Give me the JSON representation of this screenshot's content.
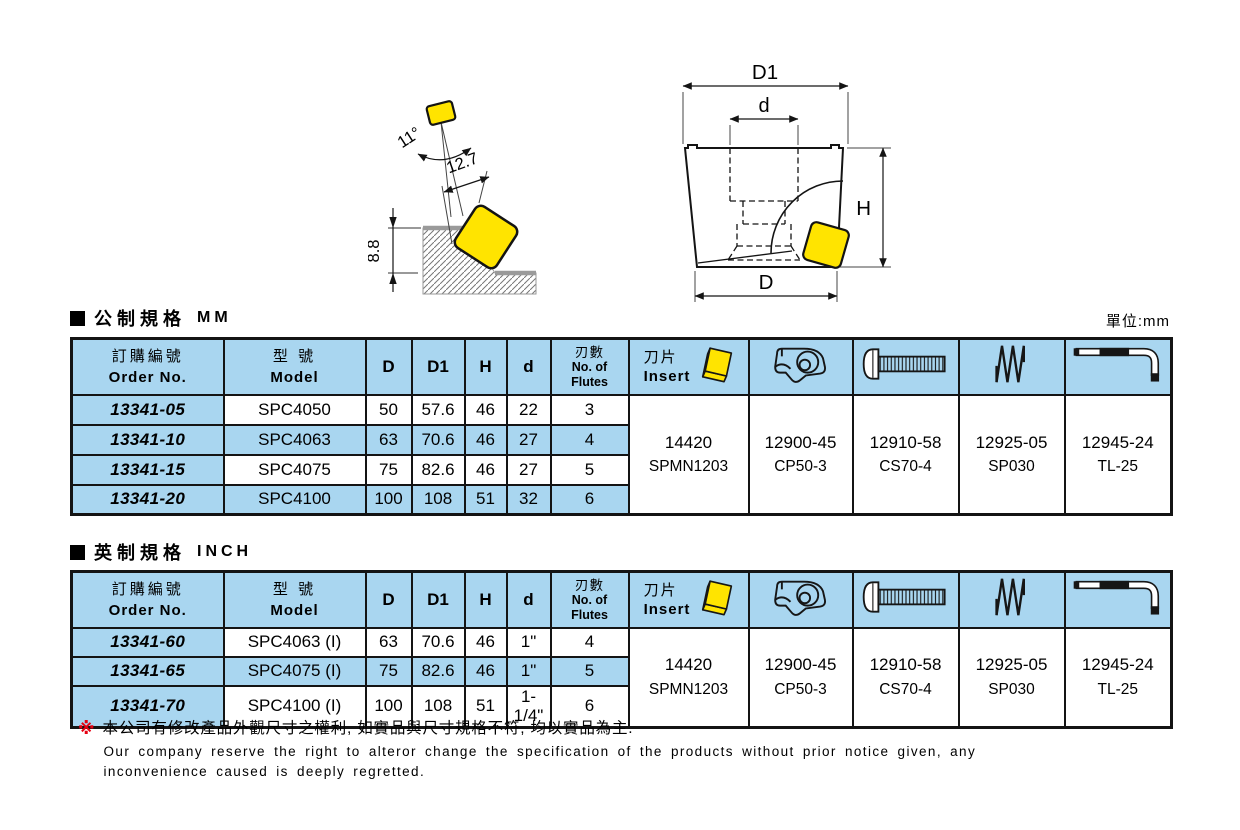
{
  "colors": {
    "header_blue": "#A9D6F0",
    "insert_yellow": "#FFE400",
    "note_red": "#E60012"
  },
  "unit_label": "單位:mm",
  "diagram_left": {
    "angle_label": "11°",
    "width_label": "12.7",
    "depth_label": "8.8"
  },
  "diagram_right": {
    "top_dia_label": "D1",
    "bore_label": "d",
    "height_label": "H",
    "bottom_dia_label": "D"
  },
  "table_headers": {
    "order_zh": "訂購編號",
    "order_en": "Order No.",
    "model_zh": "型 號",
    "model_en": "Model",
    "col_d": "D",
    "col_d1": "D1",
    "col_h": "H",
    "col_ds": "d",
    "flutes_zh": "刃數",
    "flutes_en_1": "No. of",
    "flutes_en_2": "Flutes",
    "insert_zh": "刀片",
    "insert_en": "Insert"
  },
  "metric": {
    "section_zh": "公制規格",
    "section_en": "MM",
    "rows": [
      {
        "order": "13341-05",
        "model": "SPC4050",
        "d": "50",
        "d1": "57.6",
        "h": "46",
        "ds": "22",
        "flutes": "3"
      },
      {
        "order": "13341-10",
        "model": "SPC4063",
        "d": "63",
        "d1": "70.6",
        "h": "46",
        "ds": "27",
        "flutes": "4"
      },
      {
        "order": "13341-15",
        "model": "SPC4075",
        "d": "75",
        "d1": "82.6",
        "h": "46",
        "ds": "27",
        "flutes": "5"
      },
      {
        "order": "13341-20",
        "model": "SPC4100",
        "d": "100",
        "d1": "108",
        "h": "51",
        "ds": "32",
        "flutes": "6"
      }
    ]
  },
  "inch": {
    "section_zh": "英制規格",
    "section_en": "INCH",
    "rows": [
      {
        "order": "13341-60",
        "model": "SPC4063 (I)",
        "d": "63",
        "d1": "70.6",
        "h": "46",
        "ds": "1\"",
        "flutes": "4"
      },
      {
        "order": "13341-65",
        "model": "SPC4075 (I)",
        "d": "75",
        "d1": "82.6",
        "h": "46",
        "ds": "1\"",
        "flutes": "5"
      },
      {
        "order": "13341-70",
        "model": "SPC4100 (I)",
        "d": "100",
        "d1": "108",
        "h": "51",
        "ds": "1-1/4\"",
        "flutes": "6"
      }
    ]
  },
  "parts": {
    "insert": {
      "no": "14420",
      "model": "SPMN1203"
    },
    "clamp": {
      "no": "12900-45",
      "model": "CP50-3"
    },
    "screw": {
      "no": "12910-58",
      "model": "CS70-4"
    },
    "spring": {
      "no": "12925-05",
      "model": "SP030"
    },
    "wrench": {
      "no": "12945-24",
      "model": "TL-25"
    }
  },
  "footer": {
    "marker": "※",
    "line_zh": "本公司有修改產品外觀尺寸之權利, 如實品與尺寸規格不符, 均以實品為主.",
    "line_en_1": "Our company reserve the right to alteror change the specification of the products without prior notice given, any",
    "line_en_2": "inconvenience caused is deeply regretted."
  }
}
